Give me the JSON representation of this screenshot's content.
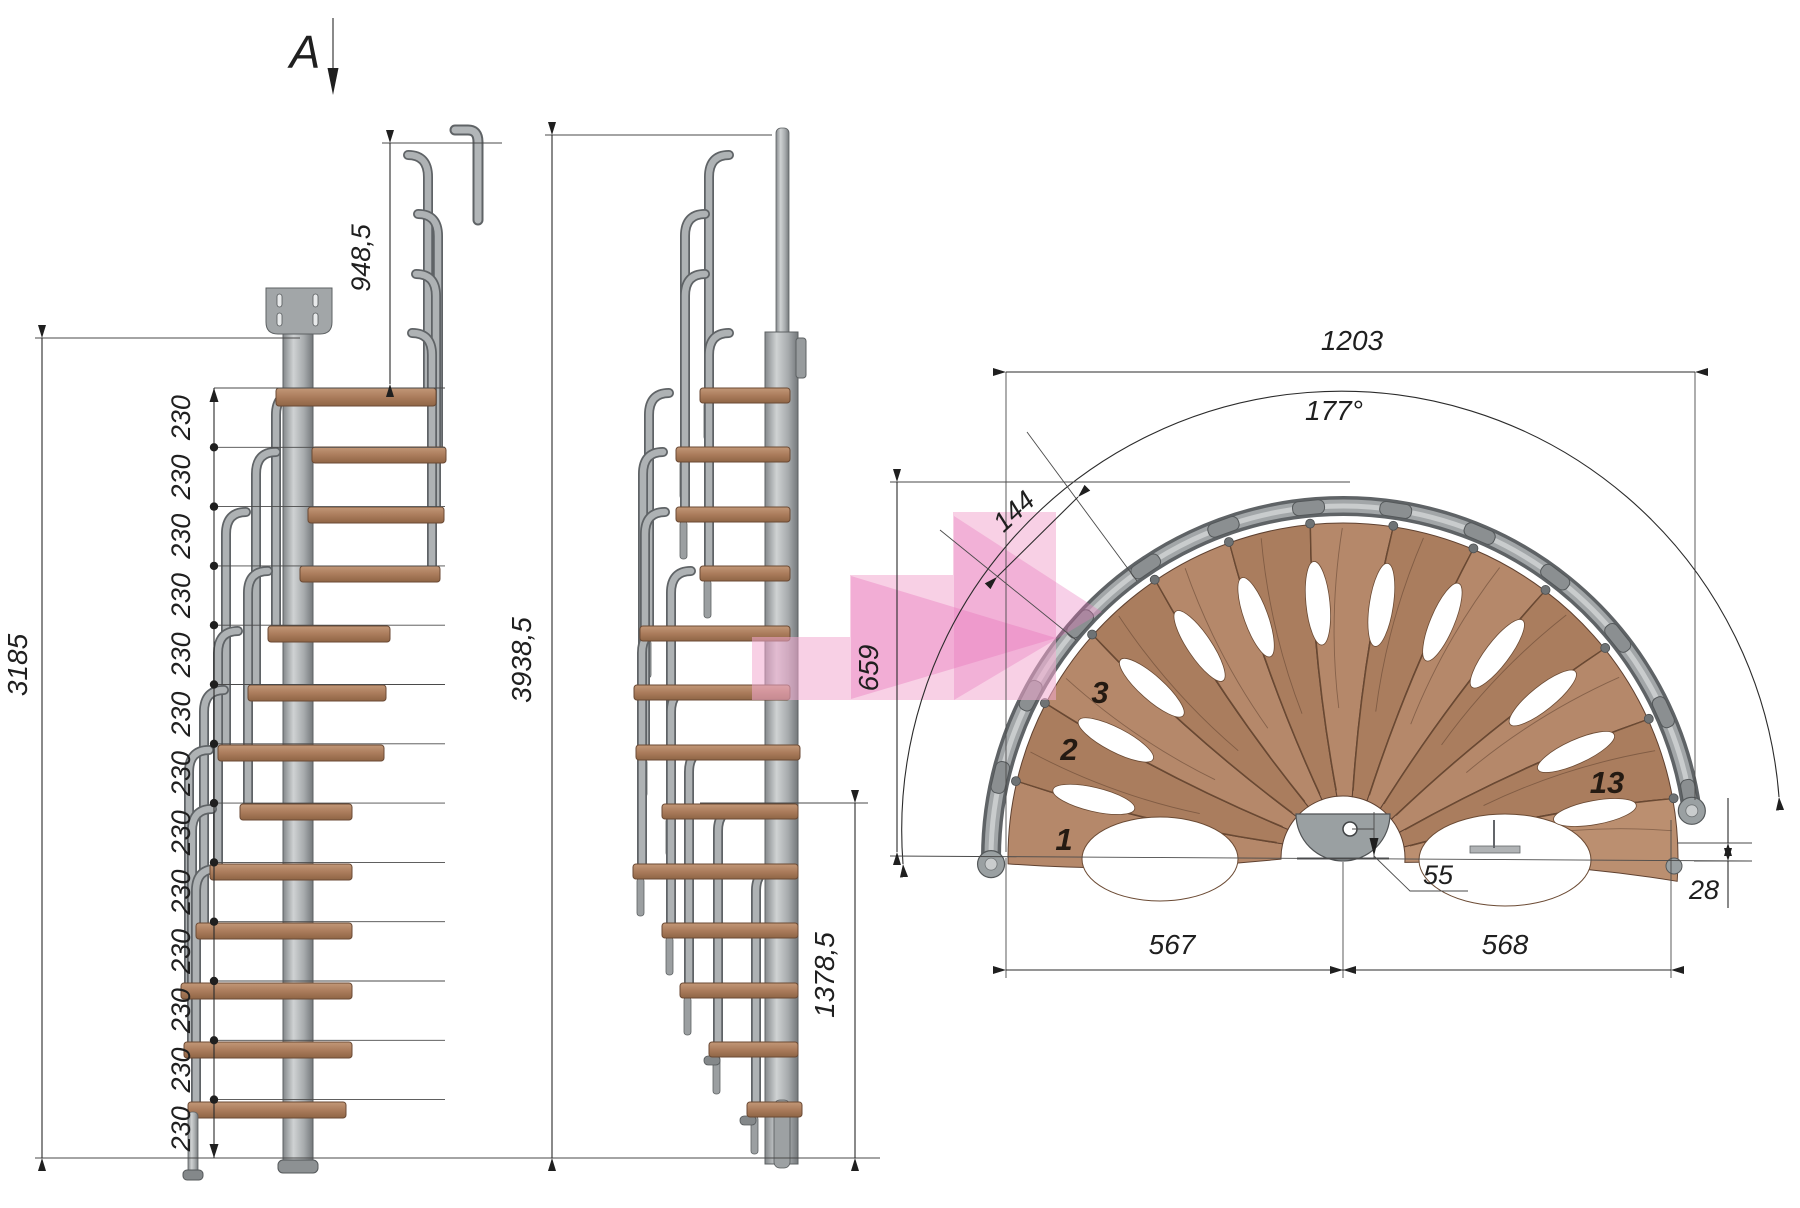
{
  "section_marker": {
    "label": "A"
  },
  "dimensions": {
    "handrail_height": "948,5",
    "bracket_height": "3185",
    "overall_height": "3938,5",
    "lower_flight_height": "1378,5",
    "riser": {
      "value": "230",
      "count": 13
    },
    "plan_width": "1203",
    "rotation_angle": "177°",
    "tread_outer_width": "144",
    "plan_depth": "659",
    "left_half_width": "567",
    "right_half_width": "568",
    "center_offset": "55",
    "edge_drop": "28"
  },
  "treads": {
    "labels": [
      "1",
      "2",
      "3",
      "13"
    ],
    "count": 13
  },
  "colors": {
    "wood": "#b5886a",
    "wood_dark": "#ac7e5f",
    "steel": "#9b9fa1",
    "steel_dark": "#63666a",
    "line": "#2b2b2b",
    "highlight_pink": "#f2a9cf"
  }
}
